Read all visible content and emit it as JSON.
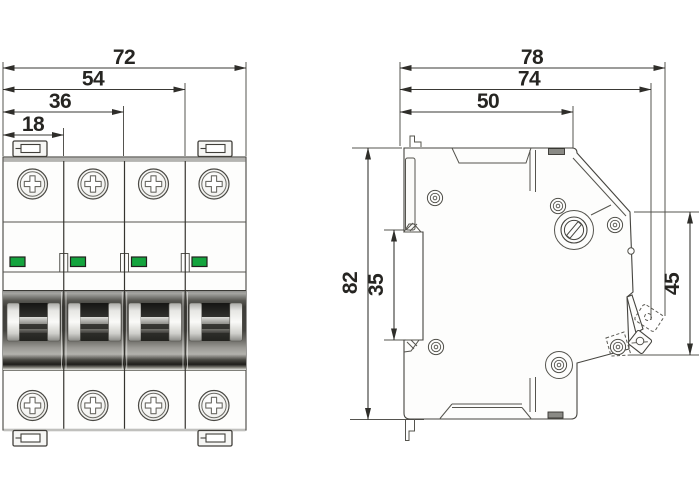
{
  "dims": {
    "front": {
      "overall_width": "72",
      "three_pole_width": "54",
      "two_pole_width": "36",
      "one_pole_width": "18"
    },
    "side": {
      "overall_depth": "78",
      "depth_with_lever": "74",
      "body_depth": "50",
      "overall_height": "82",
      "rail_slot_height": "35",
      "front_section_height": "45"
    }
  },
  "colors": {
    "line": "#45443f",
    "dimension_text": "#262522",
    "indicator_green": "#14a43e",
    "band_dark": "#3e3d39",
    "metal_highlight": "#fafaf8",
    "top_edge_gray": "#b4b4b1"
  }
}
